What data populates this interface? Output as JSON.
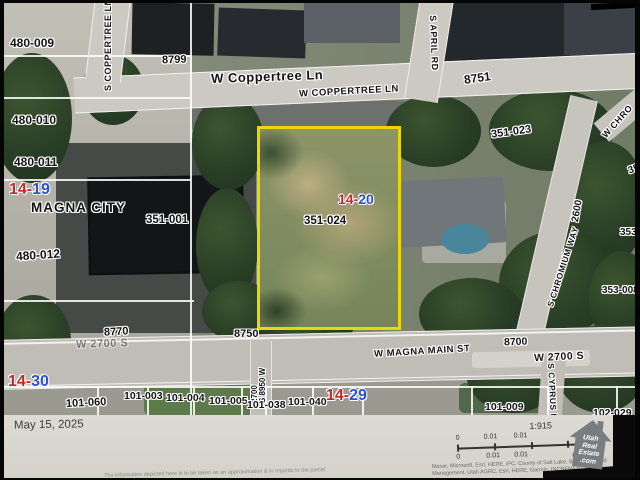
{
  "colors": {
    "parcel_outline": "#ead800",
    "section_red": "#c42727",
    "section_blue": "#2b4fd0"
  },
  "map_labels": {
    "parcel_480_009": "480-009",
    "parcel_480_010": "480-010",
    "parcel_480_011": "480-011",
    "parcel_480_012": "480-012",
    "city": "MAGNA CITY",
    "parcel_351_001": "351-001",
    "parcel_351_023": "351-023",
    "parcel_351_024": "351-024",
    "parcel_353_top": "353",
    "parcel_353_mid": "353-",
    "parcel_353_008": "353-008",
    "parcel_101_060": "101-060",
    "parcel_101_003": "101-003",
    "parcel_101_004": "101-004",
    "parcel_101_005": "101-005",
    "parcel_101_038": "101-038",
    "parcel_101_040": "101-040",
    "parcel_101_009": "101-009",
    "parcel_102_029": "102-029",
    "house_8799": "8799",
    "house_8751": "8751",
    "house_8770": "8770",
    "house_8750": "8750",
    "house_8700": "8700",
    "grid_2600": "2600",
    "grid_2700": "2700"
  },
  "streets": {
    "coppertree_main": "W Coppertree Ln",
    "coppertree_caps": "W COPPERTREE LN",
    "s_coppertree": "S COPPERTREE LN",
    "s_april": "S APRIL RD",
    "w_chro": "W CHRO",
    "s_chromium": "S CHROMIUM WAY",
    "w_2700_left": "W 2700 S",
    "w_magna_main": "W MAGNA MAIN ST",
    "w_2700_right": "W 2700 S",
    "s_cyprus": "S CYPRUS LN",
    "s_8950": "S 8950 W"
  },
  "sections": {
    "s_14_19": {
      "red": "14",
      "dash": "-",
      "blue": "19"
    },
    "s_14_20": {
      "red": "14",
      "dash": "-",
      "blue": "20"
    },
    "s_14_30": {
      "red": "14",
      "dash": "-",
      "blue": "30"
    },
    "s_14_29": {
      "red": "14",
      "dash": "-",
      "blue": "29"
    }
  },
  "footer": {
    "date": "May 15, 2025",
    "scale_ratio": "1:915",
    "mi_ticks": [
      "0",
      "0.01",
      "0.01",
      "0.02 mi"
    ],
    "km_ticks": [
      "0",
      "0.01",
      "0.01",
      "0.03 km"
    ],
    "attribution_line1": "Maxar, Microsoft, Esri, HERE, iPC, County of Salt Lake, Bureau of Land",
    "attribution_line2": "Management, Utah AGRC, Esri, HERE, Garmin, INCREMENT P, NGA",
    "disclaimer": "The information depicted here is to be taken as an approximation & in regards to the parcel",
    "logo": {
      "word1": "Utah",
      "word2": "Real",
      "word3": "Estate",
      "word4": ".com"
    }
  }
}
